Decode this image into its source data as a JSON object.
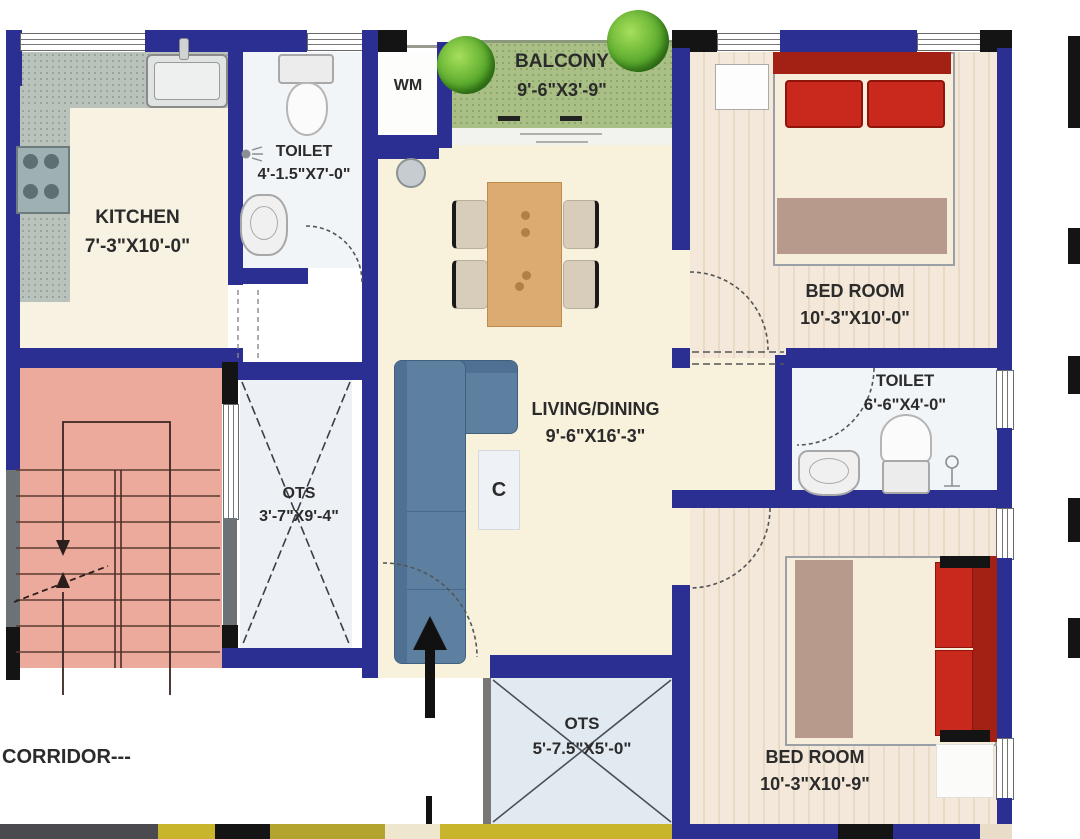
{
  "rooms": {
    "balcony": {
      "name": "BALCONY",
      "dims": "9'-6\"X3'-9\""
    },
    "wm": {
      "name": "WM"
    },
    "toilet1": {
      "name": "TOILET",
      "dims": "4'-1.5\"X7'-0\""
    },
    "kitchen": {
      "name": "KITCHEN",
      "dims": "7'-3\"X10'-0\""
    },
    "bedroom1": {
      "name": "BED ROOM",
      "dims": "10'-3\"X10'-0\""
    },
    "toilet2": {
      "name": "TOILET",
      "dims": "6'-6\"X4'-0\""
    },
    "living": {
      "name": "LIVING/DINING",
      "dims": "9'-6\"X16'-3\""
    },
    "ots1": {
      "name": "OTS",
      "dims": "3'-7\"X9'-4\""
    },
    "ots2": {
      "name": "OTS",
      "dims": "5'-7.5\"X5'-0\""
    },
    "bedroom2": {
      "name": "BED ROOM",
      "dims": "10'-3\"X10'-9\""
    },
    "corridor": {
      "name": "CORRIDOR---"
    }
  },
  "annotations": {
    "cupboard": "C"
  },
  "colors": {
    "wall_blue": "#2b2f92",
    "pier_black": "#141414",
    "stair_pink": "#ecaa9c",
    "balcony_green": "#a9bf85",
    "bed_red": "#c9281c",
    "headboard_red": "#a32015",
    "sofa_blue": "#5d80a1",
    "dining_table": "#dcab72",
    "living_cream": "#f8f1dc",
    "wood_floor": "#f3e8d9"
  }
}
